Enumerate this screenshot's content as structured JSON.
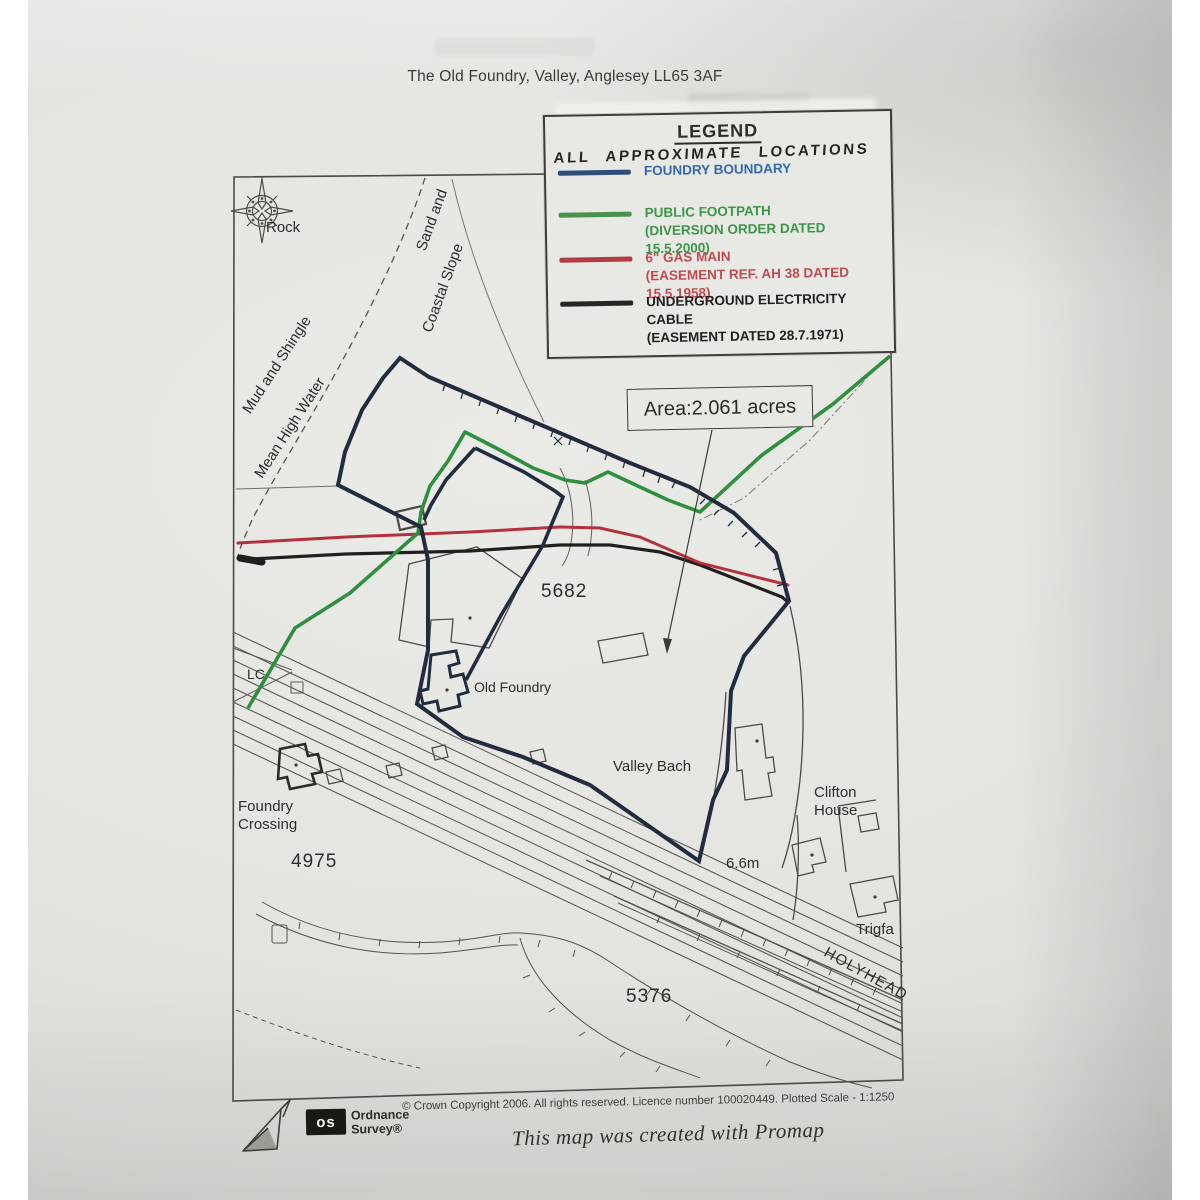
{
  "page_title": "The Old Foundry, Valley, Anglesey LL65 3AF",
  "legend": {
    "heading": "LEGEND",
    "subheading": "ALL APPROXIMATE LOCATIONS",
    "items": [
      {
        "label": "FOUNDRY BOUNDARY",
        "note": "",
        "swatch_color": "#2d4d7a",
        "text_color": "#3468ad"
      },
      {
        "label": "PUBLIC FOOTPATH",
        "note": "(DIVERSION ORDER DATED 15.5.2000)",
        "swatch_color": "#4a9150",
        "text_color": "#3d9547"
      },
      {
        "label": "6\" GAS MAIN",
        "note": "(EASEMENT REF. AH 38 DATED 15.5.1958)",
        "swatch_color": "#b23a44",
        "text_color": "#c24b52"
      },
      {
        "label": "UNDERGROUND ELECTRICITY CABLE",
        "note": "(EASEMENT DATED 28.7.1971)",
        "swatch_color": "#262624",
        "text_color": "#1f1f1d"
      }
    ]
  },
  "map": {
    "area_label": "Area:2.061 acres",
    "labels": {
      "rock": "Rock",
      "sand_and": "Sand and",
      "coastal_slope": "Coastal Slope",
      "mud_and_shingle": "Mud and Shingle",
      "mean_high_water": "Mean High Water",
      "lc": "LC",
      "parcel_5682": "5682",
      "old_foundry": "Old Foundry",
      "valley_bach": "Valley Bach",
      "foundry_crossing": "Foundry\nCrossing",
      "parcel_4975": "4975",
      "spot_height": "6.6m",
      "clifton_house": "Clifton\nHouse",
      "trigfa": "Trigfa",
      "parcel_5376": "5376",
      "holyhead": "HOLYHEAD"
    },
    "line_colors": {
      "boundary": "#232c3e",
      "footpath": "#2f8f3e",
      "gas_main": "#b5303d",
      "electricity_cable": "#211f1d"
    }
  },
  "footer": {
    "copyright": "© Crown Copyright 2006. All rights reserved. Licence number 100020449. Plotted Scale - 1:1250",
    "os_logo_text": "os",
    "os_name": "Ordnance\nSurvey®",
    "promap_credit": "This map was created with Promap"
  }
}
